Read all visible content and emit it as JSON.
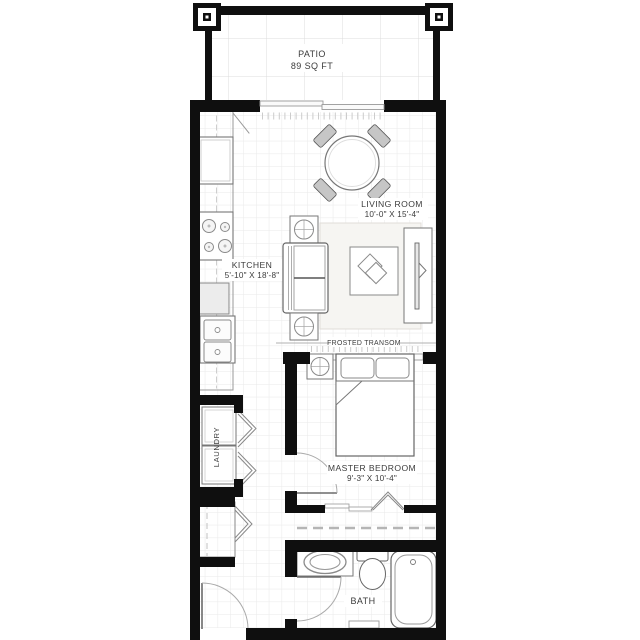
{
  "rooms": {
    "patio": {
      "name": "PATIO",
      "area": "89 SQ FT"
    },
    "living_room": {
      "name": "LIVING ROOM",
      "dims": "10'-0\" X 15'-4\""
    },
    "kitchen": {
      "name": "KITCHEN",
      "dims": "5'-10\" X 18'-8\""
    },
    "master_bedroom": {
      "name": "MASTER BEDROOM",
      "dims": "9'-3\" X 10'-4\""
    },
    "laundry": {
      "name": "LAUNDRY"
    },
    "bath": {
      "name": "BATH"
    }
  },
  "annotations": {
    "frosted_transom": "FROSTED TRANSOM"
  },
  "colors": {
    "wall": "#0f0f0f",
    "furniture_line": "#6b6b6b",
    "grid_small": "#e9e9e9",
    "grid_large": "#dcdcdc",
    "text": "#3c3c3c"
  }
}
